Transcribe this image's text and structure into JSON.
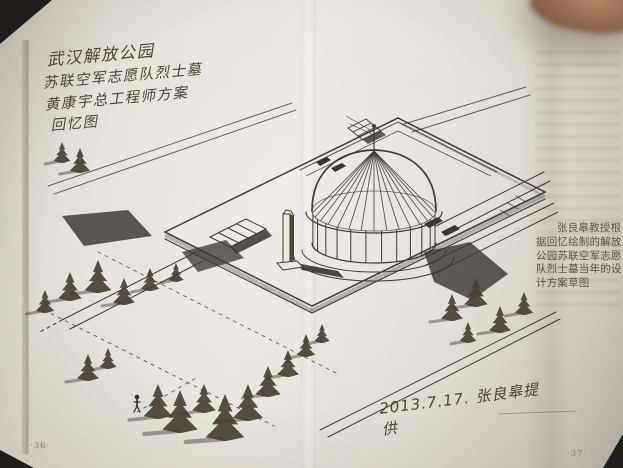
{
  "book_page": {
    "handwritten_title": {
      "line1": "武汉解放公园",
      "line2": "苏联空军志愿队烈士墓",
      "line3": "黄康宇总工程师方案",
      "line4": "回忆图"
    },
    "date_signature": "2013.7.17. 张良皋提供",
    "page_number_left": "·36·",
    "page_number_right": "·37·",
    "printed_caption_lines": [
      "张良皋教授根",
      "据回忆绘制的解放",
      "公园苏联空军志愿",
      "队烈士墓当年的设",
      "计方案草图"
    ]
  },
  "colors": {
    "paper": "#e3ded5",
    "background": "#211d18",
    "handwriting_ink": "#4a4336",
    "caption_ink": "#5a5244",
    "finger_skin": "#8a6147"
  },
  "sketch": {
    "subject": "isometric-sketch-of-memorial-park-with-ribbed-dome-pavilion-obelisk-stairs-and-pine-trees",
    "ink": "#3f3a32",
    "ink_dark": "#332e26",
    "tree_fill": "#474034",
    "dome": {
      "cx": 374,
      "apex_y": 151,
      "ring_y": 211,
      "rx": 62,
      "ry": 20,
      "drum_bottom_y": 243
    },
    "trees": [
      {
        "x": 62,
        "y": 162,
        "h": 20
      },
      {
        "x": 80,
        "y": 172,
        "h": 24
      },
      {
        "x": 45,
        "y": 312,
        "h": 22
      },
      {
        "x": 70,
        "y": 300,
        "h": 28
      },
      {
        "x": 98,
        "y": 292,
        "h": 32
      },
      {
        "x": 124,
        "y": 304,
        "h": 26
      },
      {
        "x": 150,
        "y": 290,
        "h": 22
      },
      {
        "x": 176,
        "y": 281,
        "h": 18
      },
      {
        "x": 88,
        "y": 380,
        "h": 26
      },
      {
        "x": 108,
        "y": 368,
        "h": 20
      },
      {
        "x": 158,
        "y": 418,
        "h": 34
      },
      {
        "x": 180,
        "y": 432,
        "h": 42
      },
      {
        "x": 204,
        "y": 412,
        "h": 28
      },
      {
        "x": 225,
        "y": 440,
        "h": 46
      },
      {
        "x": 248,
        "y": 420,
        "h": 36
      },
      {
        "x": 268,
        "y": 396,
        "h": 30
      },
      {
        "x": 288,
        "y": 376,
        "h": 26
      },
      {
        "x": 306,
        "y": 356,
        "h": 22
      },
      {
        "x": 322,
        "y": 342,
        "h": 18
      },
      {
        "x": 452,
        "y": 320,
        "h": 26
      },
      {
        "x": 476,
        "y": 306,
        "h": 28
      },
      {
        "x": 500,
        "y": 332,
        "h": 26
      },
      {
        "x": 524,
        "y": 314,
        "h": 22
      },
      {
        "x": 468,
        "y": 342,
        "h": 20
      }
    ],
    "figure": {
      "x": 137,
      "y": 410
    }
  }
}
